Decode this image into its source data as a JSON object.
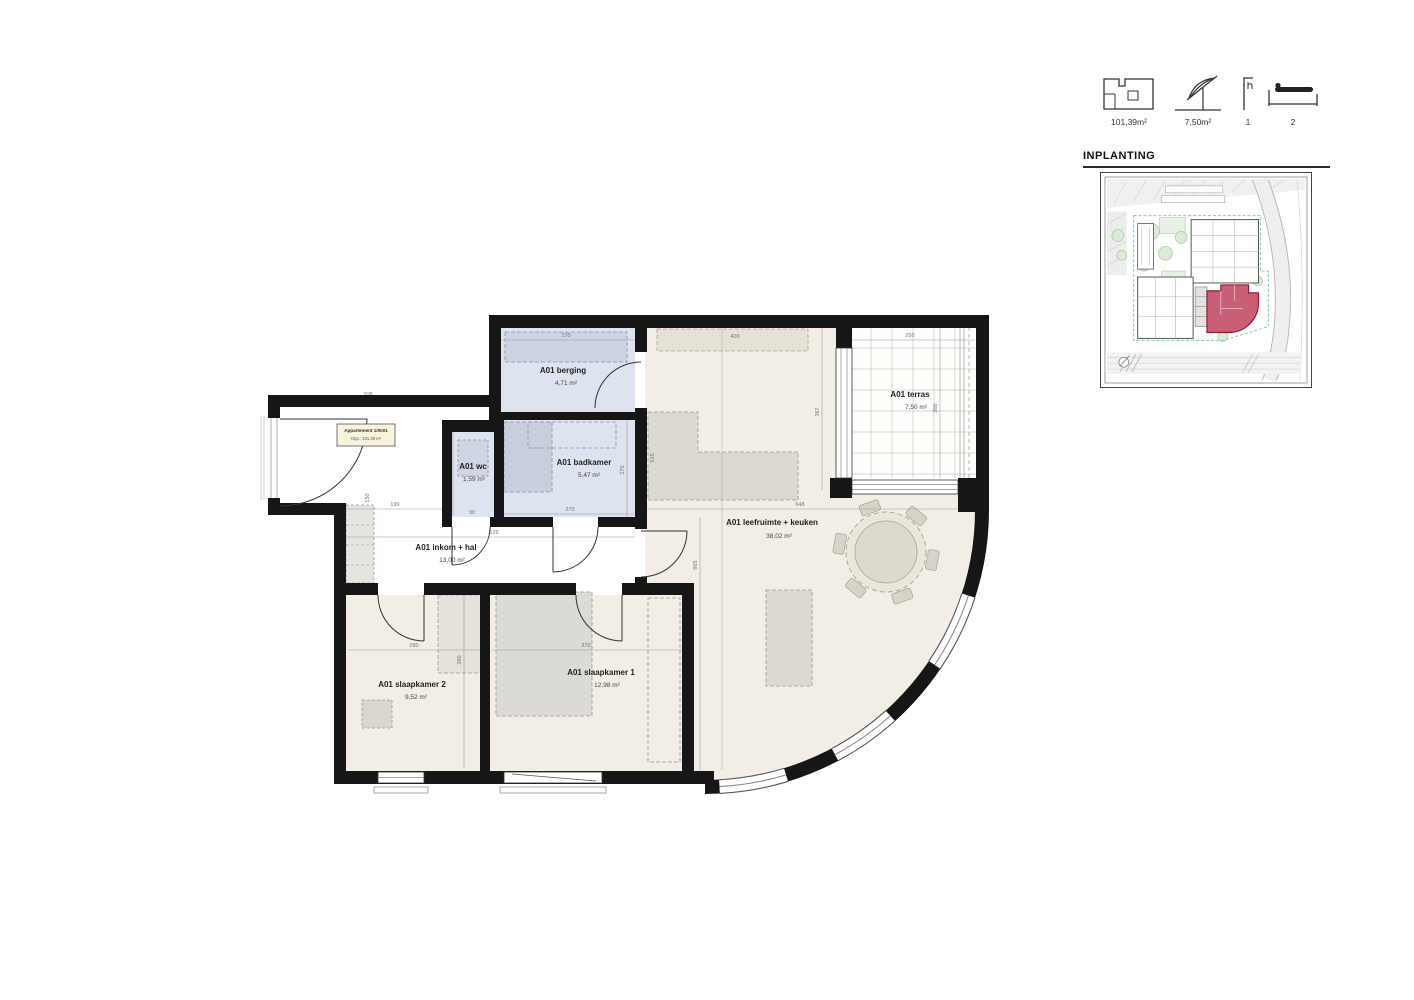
{
  "legend": {
    "items": [
      {
        "icon": "apartment-plan-icon",
        "value": "101,39m²"
      },
      {
        "icon": "terrace-parasol-icon",
        "value": "7,50m²"
      },
      {
        "icon": "bathroom-icon",
        "value": "1"
      },
      {
        "icon": "bedroom-bed-icon",
        "value": "2"
      }
    ]
  },
  "site_plan": {
    "title": "INPLANTING",
    "highlight_color": "#c4506a"
  },
  "apartment_tag": {
    "line1": "Appartement 1/0001",
    "line2": "Opp.: 101,39 m²"
  },
  "rooms": {
    "berging": {
      "name": "A01 berging",
      "area": "4,71 m²"
    },
    "wc": {
      "name": "A01 wc",
      "area": "1,59 m²"
    },
    "badkamer": {
      "name": "A01 badkamer",
      "area": "5,47 m²"
    },
    "inkom": {
      "name": "A01 inkom + hal",
      "area": "13,00 m²"
    },
    "leefruimte": {
      "name": "A01 leefruimte + keuken",
      "area": "38,02 m²"
    },
    "slaapkamer1": {
      "name": "A01 slaapkamer 1",
      "area": "12,98 m²"
    },
    "slaapkamer2": {
      "name": "A01 slaapkamer 2",
      "area": "9,52 m²"
    },
    "terras": {
      "name": "A01 terras",
      "area": "7,50 m²"
    }
  },
  "dims": {
    "entrance_width": "308",
    "berging_width": "270",
    "kitchen_counter_width": "400",
    "terras_width": "250",
    "terras_depth": "300",
    "living_width": "648",
    "living_depth": "367",
    "living_height": "865",
    "hall_segment": "199",
    "closet_height": "150",
    "hall_width": "529",
    "wc_width": "90",
    "wc_depth": "177",
    "badkamer_width": "270",
    "badkamer_depth": "270",
    "slaapkamer2_width": "280",
    "slaapkamer1_width": "370",
    "slaapkamer_depth": "360",
    "island_length": "515"
  },
  "colors": {
    "wall": "#161616",
    "wet_room_fill": "#dde3ef",
    "floor_fill": "#f2eee6",
    "furniture_fill": "#dbd9d2"
  }
}
